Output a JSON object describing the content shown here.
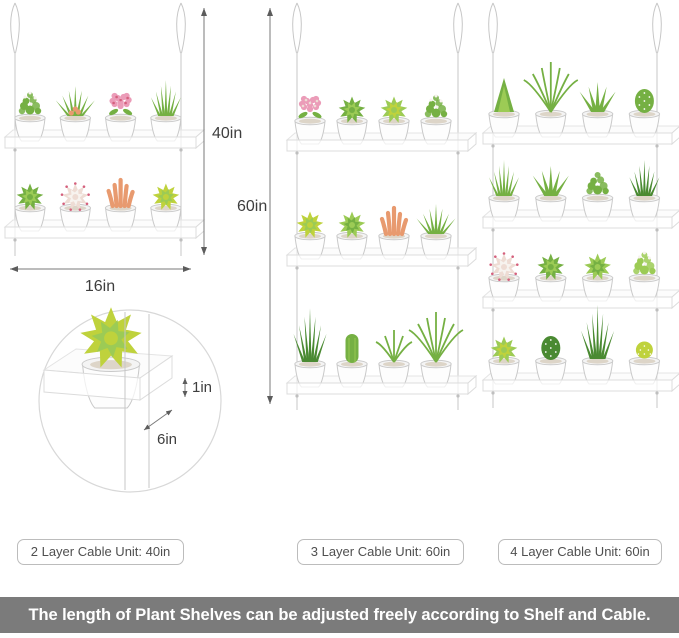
{
  "title_banner": "The length of Plant Shelves can be adjusted freely according to Shelf and Cable.",
  "unit_labels": [
    "2 Layer Cable Unit: 40in",
    "3 Layer Cable Unit: 60in",
    "4 Layer Cable Unit: 60in"
  ],
  "dimensions": {
    "unit2layer_height": "40in",
    "unit3layer_height": "60in",
    "shelf_width": "16in",
    "shelf_lip_height": "1in",
    "shelf_depth": "6in"
  },
  "colors": {
    "banner_bg": "#7b7b7b",
    "banner_text": "#ffffff",
    "dimension_line": "#7a7a7a",
    "label_border": "#bcbcbc",
    "label_text": "#4f4f4f",
    "cable": "#c7c7c7",
    "shelf_edge": "#dcdcdc",
    "pot_fill": "#fdfdfd",
    "pot_stroke": "#c9c9c9"
  },
  "plant_palette": {
    "green": "#75b043",
    "light_green": "#9ccb55",
    "dark_green": "#4a8a32",
    "yellow_green": "#bfd23c",
    "pink": "#eb9cb8",
    "red_pink": "#d5607d",
    "coral": "#e89a6f",
    "pale": "#eedcd4",
    "white_accent": "#f7f3ef"
  },
  "units": [
    [
      [
        {
          "t": "bush",
          "c": "green",
          "a": "white_accent"
        },
        {
          "t": "spiky",
          "c": "green",
          "a": "coral"
        },
        {
          "t": "flower",
          "c": "pink",
          "a": "red_pink"
        },
        {
          "t": "grass",
          "c": "green"
        }
      ],
      [
        {
          "t": "rosette",
          "c": "green",
          "a": "light_green"
        },
        {
          "t": "rosette",
          "c": "pale",
          "a": "white_accent",
          "d": "red_pink"
        },
        {
          "t": "coral",
          "c": "coral"
        },
        {
          "t": "rosette",
          "c": "yellow_green",
          "a": "light_green"
        }
      ]
    ],
    [
      [
        {
          "t": "flower",
          "c": "pink",
          "a": "pale"
        },
        {
          "t": "rosette",
          "c": "green",
          "a": "light_green"
        },
        {
          "t": "rosette",
          "c": "light_green",
          "a": "yellow_green"
        },
        {
          "t": "bush",
          "c": "green",
          "a": "white_accent"
        }
      ],
      [
        {
          "t": "rosette",
          "c": "yellow_green",
          "a": "light_green"
        },
        {
          "t": "rosette",
          "c": "light_green",
          "a": "green"
        },
        {
          "t": "coral",
          "c": "coral"
        },
        {
          "t": "spiky",
          "c": "green"
        }
      ],
      [
        {
          "t": "grass-tall",
          "c": "dark_green"
        },
        {
          "t": "cactus-column",
          "c": "green"
        },
        {
          "t": "fern",
          "c": "green"
        },
        {
          "t": "fern-tall",
          "c": "green"
        }
      ]
    ],
    [
      [
        {
          "t": "pine",
          "c": "green"
        },
        {
          "t": "fern-tall",
          "c": "green"
        },
        {
          "t": "aloe",
          "c": "green"
        },
        {
          "t": "cactus-barrel",
          "c": "green"
        }
      ],
      [
        {
          "t": "grass",
          "c": "green"
        },
        {
          "t": "aloe",
          "c": "green"
        },
        {
          "t": "bush",
          "c": "green"
        },
        {
          "t": "grass",
          "c": "dark_green"
        }
      ],
      [
        {
          "t": "rosette",
          "c": "pale",
          "a": "white_accent",
          "d": "red_pink"
        },
        {
          "t": "rosette",
          "c": "green",
          "a": "light_green"
        },
        {
          "t": "rosette",
          "c": "light_green",
          "a": "green"
        },
        {
          "t": "bush",
          "c": "light_green",
          "a": "white_accent"
        }
      ],
      [
        {
          "t": "rosette",
          "c": "light_green",
          "a": "yellow_green"
        },
        {
          "t": "cactus-barrel",
          "c": "dark_green"
        },
        {
          "t": "grass-tall",
          "c": "dark_green"
        },
        {
          "t": "cactus-round",
          "c": "yellow_green"
        }
      ]
    ]
  ],
  "detail_plant": {
    "t": "rosette",
    "c": "yellow_green",
    "a": "light_green"
  }
}
